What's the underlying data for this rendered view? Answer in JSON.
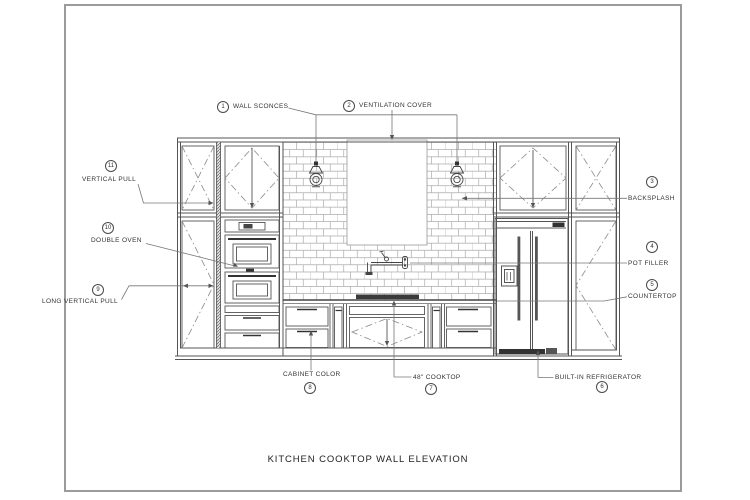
{
  "sheet": {
    "title": "KITCHEN COOKTOP WALL ELEVATION"
  },
  "callouts": {
    "wall_sconces": {
      "num": "1",
      "label": "WALL SCONCES"
    },
    "ventilation_cover": {
      "num": "2",
      "label": "VENTILATION COVER"
    },
    "backsplash": {
      "num": "3",
      "label": "BACKSPLASH"
    },
    "pot_filler": {
      "num": "4",
      "label": "POT FILLER"
    },
    "countertop": {
      "num": "5",
      "label": "COUNTERTOP"
    },
    "built_in_refrigerator": {
      "num": "6",
      "label": "BUILT-IN REFRIGERATOR"
    },
    "cooktop_48": {
      "num": "7",
      "label": "48\" COOKTOP"
    },
    "cabinet_color": {
      "num": "8",
      "label": "CABINET COLOR"
    },
    "long_vertical_pull": {
      "num": "9",
      "label": "LONG VERTICAL PULL"
    },
    "double_oven": {
      "num": "10",
      "label": "DOUBLE OVEN"
    },
    "vertical_pull": {
      "num": "11",
      "label": "VERTICAL PULL"
    }
  },
  "colors": {
    "line": "#555555",
    "dark": "#333333",
    "tile": "#aaaaaa",
    "leader": "#777777",
    "frame": "#9b9b9b",
    "text": "#333333"
  }
}
